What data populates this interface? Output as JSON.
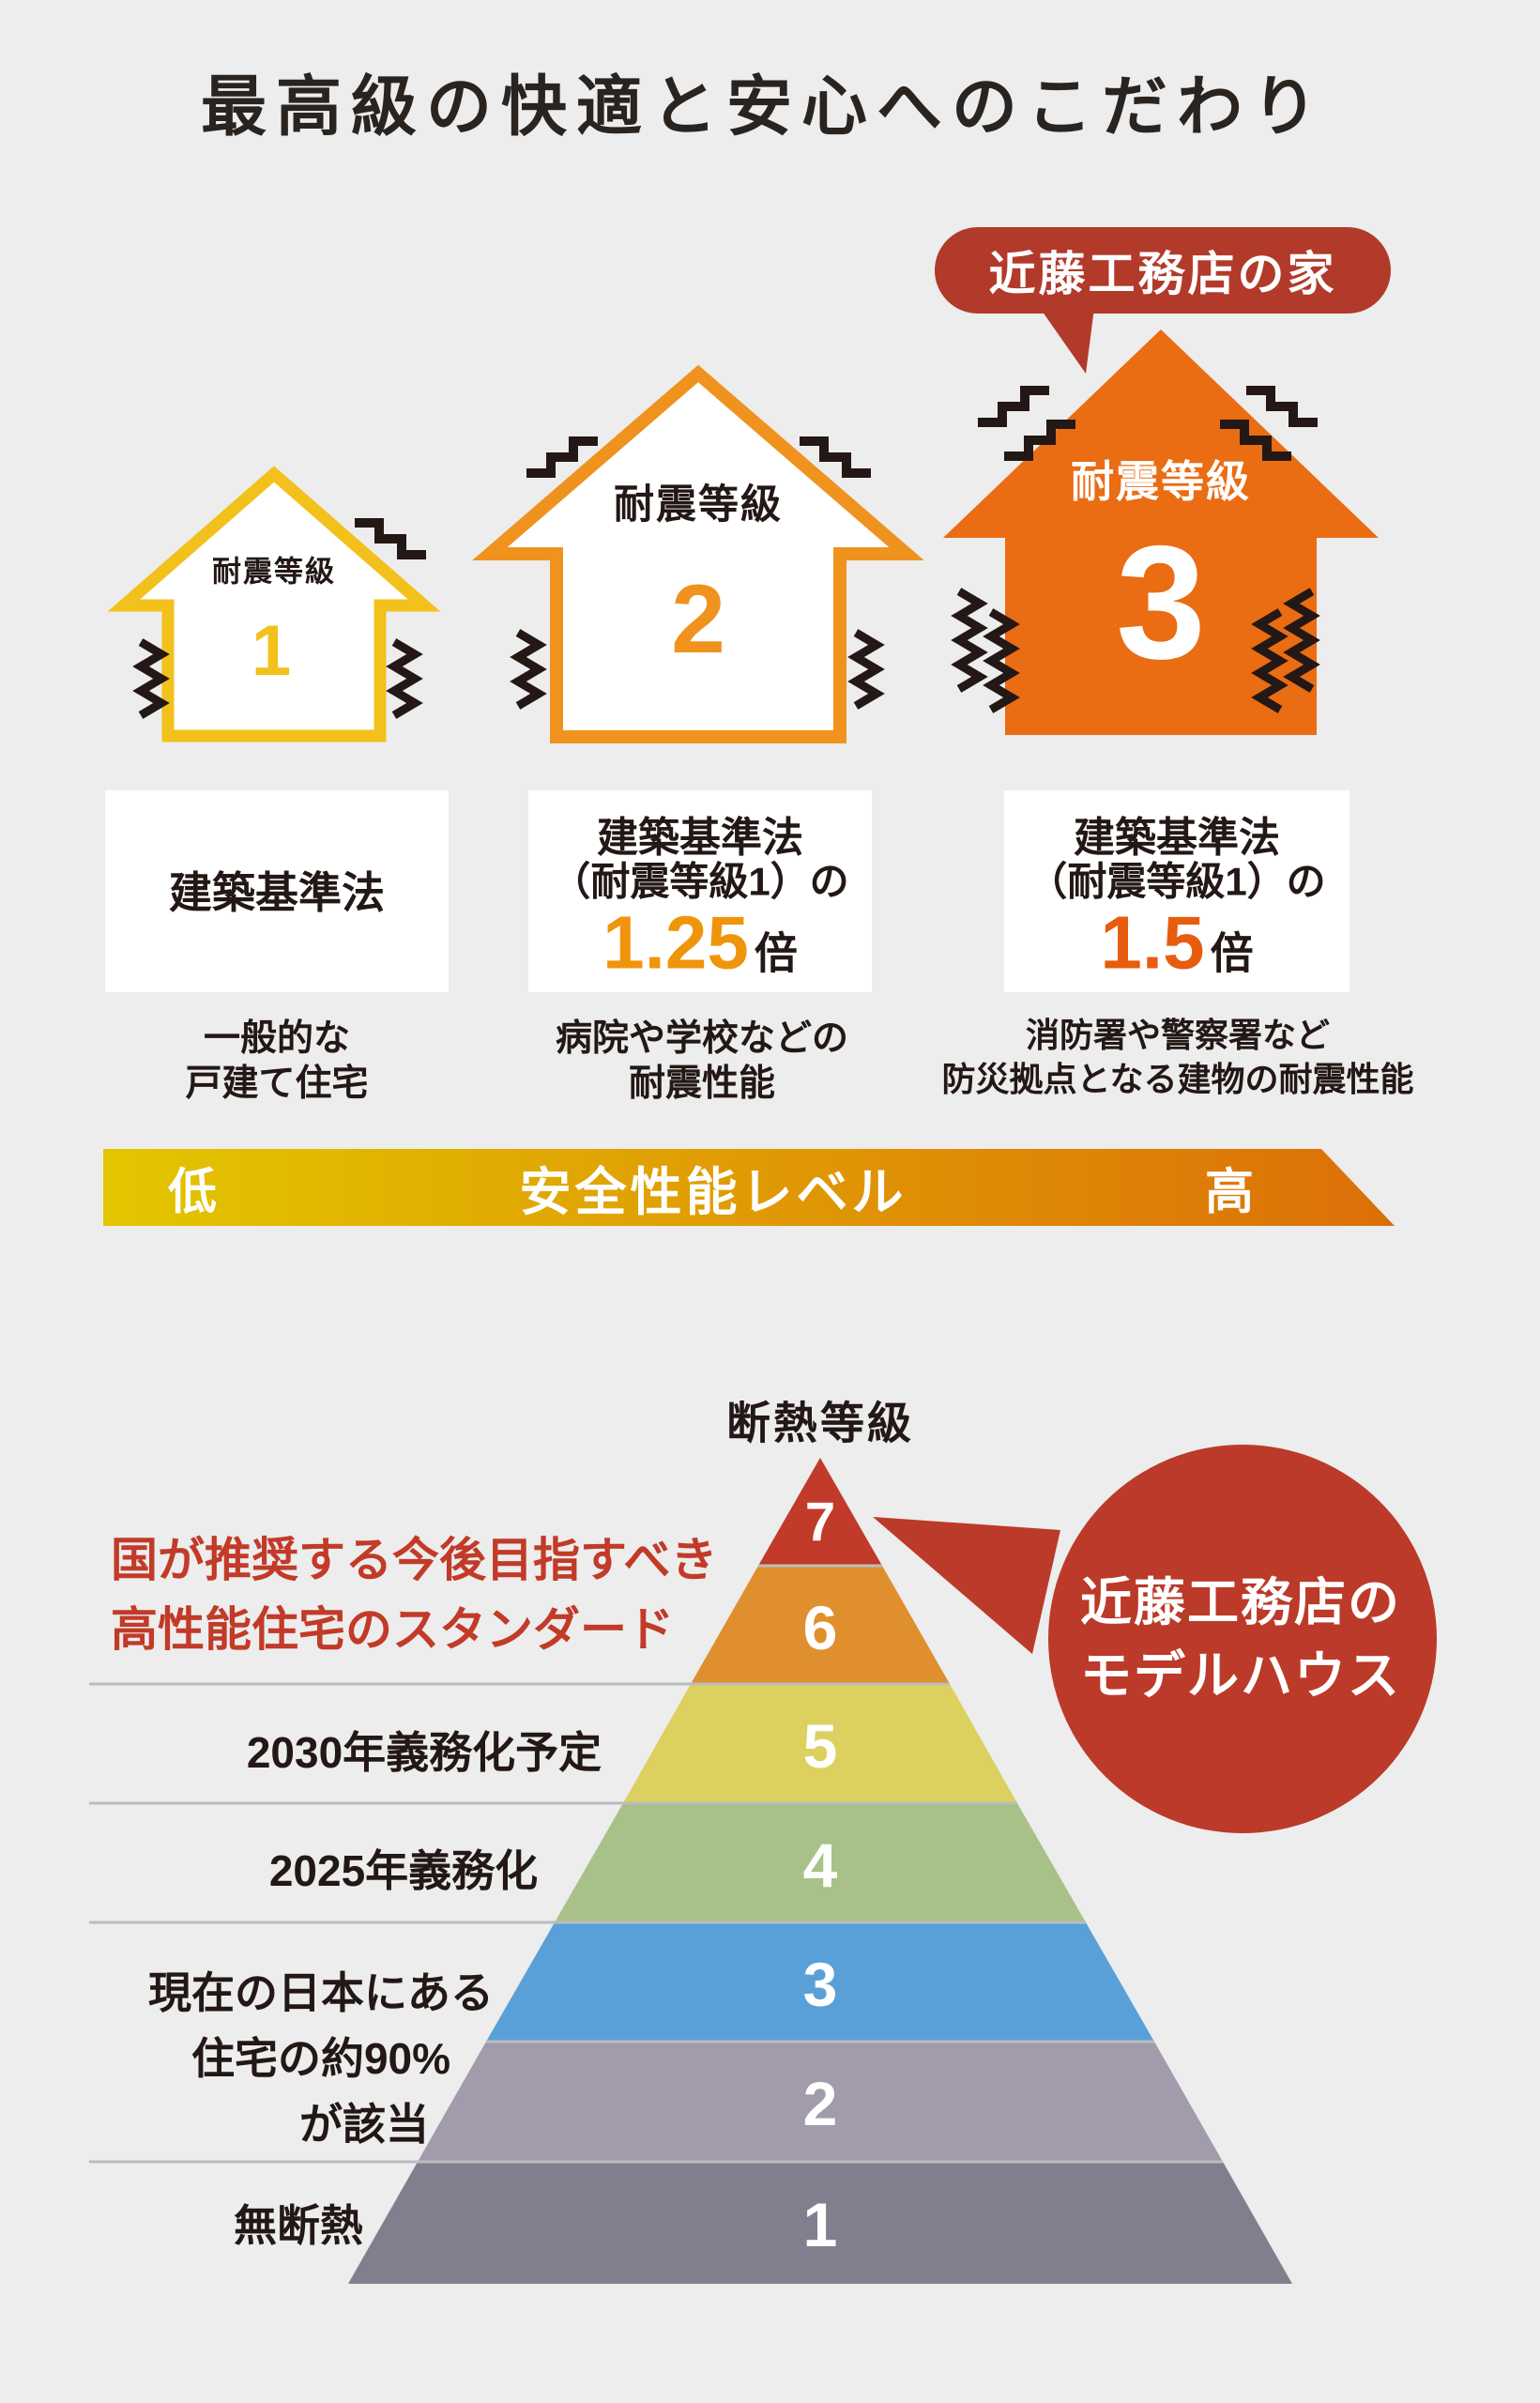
{
  "page": {
    "title": "最高級の快適と安心へのこだわり",
    "background_color": "#ecedec",
    "text_black": "#231815"
  },
  "seismic": {
    "badge_label": "近藤工務店の家",
    "badge_color": "#b23a2b",
    "houses": [
      {
        "grade_title": "耐震等級",
        "grade": "1",
        "color": "#f2c11c",
        "spec_line1": "建築基準法",
        "spec_line2": "",
        "multiplier": "",
        "multiplier_unit": "",
        "caption_line1": "一般的な",
        "caption_line2": "戸建て住宅"
      },
      {
        "grade_title": "耐震等級",
        "grade": "2",
        "color": "#f0921e",
        "spec_line1": "建築基準法",
        "spec_line2": "（耐震等級1）の",
        "multiplier": "1.25",
        "multiplier_color": "#f0940b",
        "multiplier_unit": "倍",
        "caption_line1": "病院や学校などの",
        "caption_line2": "耐震性能"
      },
      {
        "grade_title": "耐震等級",
        "grade": "3",
        "color": "#ea6c13",
        "spec_line1": "建築基準法",
        "spec_line2": "（耐震等級1）の",
        "multiplier": "1.5",
        "multiplier_color": "#e75c0e",
        "multiplier_unit": "倍",
        "caption_line1": "消防署や警察署など",
        "caption_line2": "防災拠点となる建物の耐震性能"
      }
    ],
    "axis": {
      "low": "低",
      "label": "安全性能レベル",
      "high": "高",
      "gradient_from": "#e3c600",
      "gradient_to": "#dc6f08"
    }
  },
  "insulation": {
    "title": "断熱等級",
    "note_line1": "国が推奨する今後目指すべき",
    "note_line2": "高性能住宅のスタンダード",
    "note_color": "#c23a28",
    "callout_line1": "近藤工務店の",
    "callout_line2": "モデルハウス",
    "callout_color": "#bc3a29",
    "tiers": [
      {
        "grade": "7",
        "color": "#c13a2a"
      },
      {
        "grade": "6",
        "color": "#df8f2d"
      },
      {
        "grade": "5",
        "color": "#dcd05e"
      },
      {
        "grade": "4",
        "color": "#a8c189"
      },
      {
        "grade": "3",
        "color": "#5aa0d8"
      },
      {
        "grade": "2",
        "color": "#a19bac"
      },
      {
        "grade": "1",
        "color": "#837e8e"
      }
    ],
    "row_labels": {
      "tier5": "2030年義務化予定",
      "tier4": "2025年義務化",
      "tier32_line1": "現在の日本にある",
      "tier32_line2": "住宅の約90%",
      "tier32_line3": "が該当",
      "tier1": "無断熱"
    }
  }
}
